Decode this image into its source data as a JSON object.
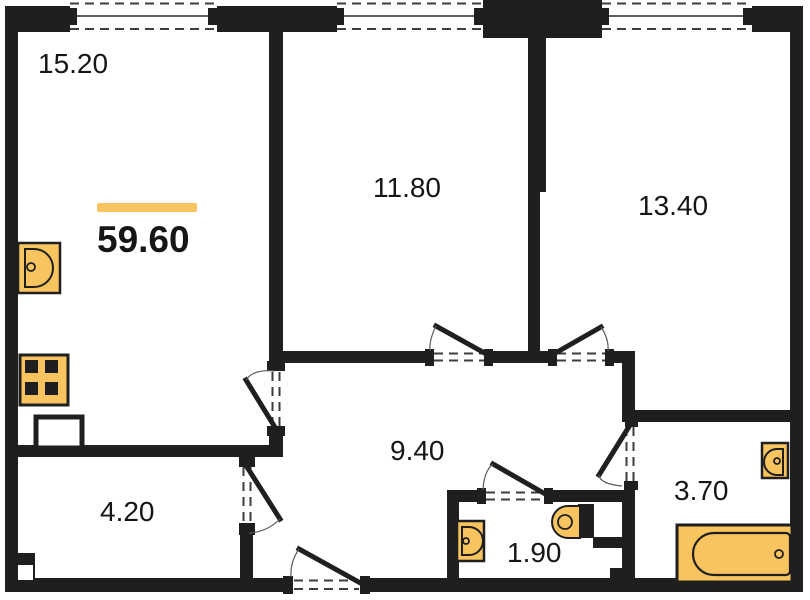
{
  "total_area": "59.60",
  "rooms": [
    {
      "name": "living-kitchen",
      "area": "15.20"
    },
    {
      "name": "bedroom-1",
      "area": "11.80"
    },
    {
      "name": "bedroom-2",
      "area": "13.40"
    },
    {
      "name": "hallway",
      "area": "9.40"
    },
    {
      "name": "storage",
      "area": "4.20"
    },
    {
      "name": "wc",
      "area": "1.90"
    },
    {
      "name": "bathroom",
      "area": "3.70"
    }
  ],
  "fixtures": [
    "kitchen-sink-icon",
    "stove-icon",
    "washing-machine-icon",
    "wc-sink-icon",
    "toilet-icon",
    "bath-sink-icon",
    "bathtub-icon"
  ],
  "colors": {
    "wall": "#1f1f1f",
    "fixture_fill": "#F7C45F",
    "accent_bar": "#F7C45F",
    "background": "#ffffff",
    "text": "#161616"
  }
}
